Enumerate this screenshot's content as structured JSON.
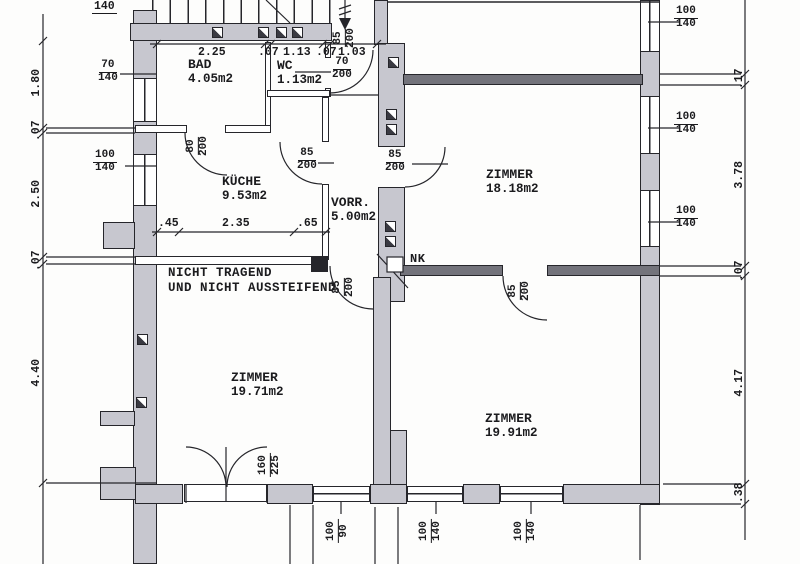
{
  "title": "Wohnungsplan Grundriss",
  "rooms": [
    {
      "name": "BAD",
      "area": "4.05m2"
    },
    {
      "name": "WC",
      "area": "1.13m2"
    },
    {
      "name": "KÜCHE",
      "area": "9.53m2"
    },
    {
      "name": "VORR.",
      "area": "5.00m2"
    },
    {
      "name": "ZIMMER",
      "area": "18.18m2"
    },
    {
      "name": "ZIMMER",
      "area": "19.71m2"
    },
    {
      "name": "ZIMMER",
      "area": "19.91m2"
    }
  ],
  "notes": {
    "line1": "NICHT TRAGEND",
    "line2": "UND NICHT AUSSTEIFEND",
    "chimney": "NK",
    "partial_top": "140"
  },
  "doors": {
    "entrance": {
      "num": "85",
      "den": "200"
    },
    "wc": {
      "num": "70",
      "den": "200"
    },
    "bad": {
      "num": "80",
      "den": "200"
    },
    "kueche": {
      "num": "85",
      "den": "200"
    },
    "vorr_zimmer": {
      "num": "85",
      "den": "200"
    },
    "vorr_south": {
      "num": "85",
      "den": "200"
    },
    "zimmer_connect": {
      "num": "85",
      "den": "200"
    },
    "french": {
      "num": "160",
      "den": "225"
    }
  },
  "windows": {
    "bad": {
      "num": "70",
      "den": "140"
    },
    "kueche": {
      "num": "100",
      "den": "140"
    },
    "right1": {
      "num": "100",
      "den": "140"
    },
    "right2": {
      "num": "100",
      "den": "140"
    },
    "right3": {
      "num": "100",
      "den": "140"
    },
    "bottom1": {
      "num": "100",
      "den": "90"
    },
    "bottom2": {
      "num": "100",
      "den": "140"
    },
    "bottom3": {
      "num": "100",
      "den": "140"
    }
  },
  "dims": {
    "top": [
      "2.25",
      ".07",
      "1.13",
      ".07",
      "1.03"
    ],
    "kitchen": [
      ".45",
      "2.35",
      ".65"
    ],
    "left": [
      "1.80",
      ".07",
      "2.50",
      ".07",
      "4.40"
    ],
    "right": [
      ".17",
      "3.78",
      ".07",
      "4.17",
      ".38"
    ]
  }
}
